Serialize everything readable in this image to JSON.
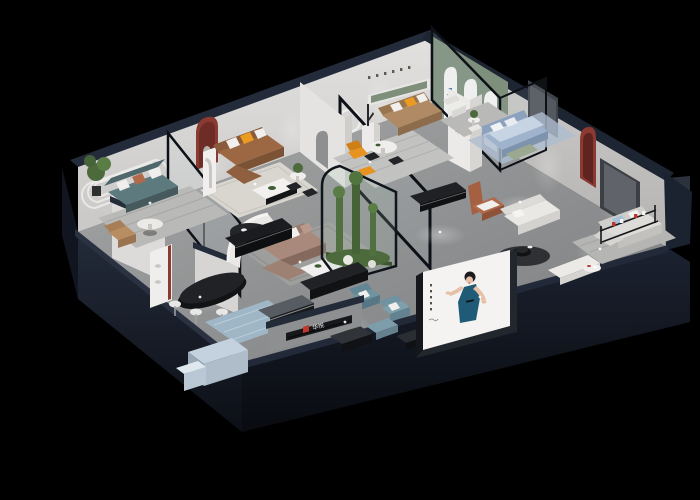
{
  "brand": {
    "name_zh": "华悦",
    "logo_letter": "H",
    "logo_black": "#1b1b1d",
    "logo_red": "#c2372c",
    "arch_logo_blue": "#3f7fa6"
  },
  "signs": {
    "pillar_logo_text": "华悦",
    "lowwall_sign_text": "华悦"
  },
  "palette": {
    "background": "#000000",
    "floor": "#8e9091",
    "wall_light": "#d8d7d5",
    "wall_shaded": "#c3c2c0",
    "wall_cap_navy": "#232b3a",
    "slab_skirt": "#171c28",
    "glass_frame": "#0d1117",
    "green_wall": "#7e8f7c",
    "accent_red": "#8a3a31",
    "sofa_teal": "#5d7a7e",
    "sofa_brown": "#9c6844",
    "sofa_tan": "#b08a64",
    "sofa_taupe": "#a8897b",
    "chair_rust": "#b06a4a",
    "armchair_blue": "#6f93a0",
    "accent_orange": "#eb9a22",
    "bed_blue": "#9fb3cc",
    "desk_blue": "#c3d2de",
    "plant_green": "#4c6a3c",
    "poster_dress": "#1f5b76",
    "poster_bg": "#f4f3f1"
  }
}
